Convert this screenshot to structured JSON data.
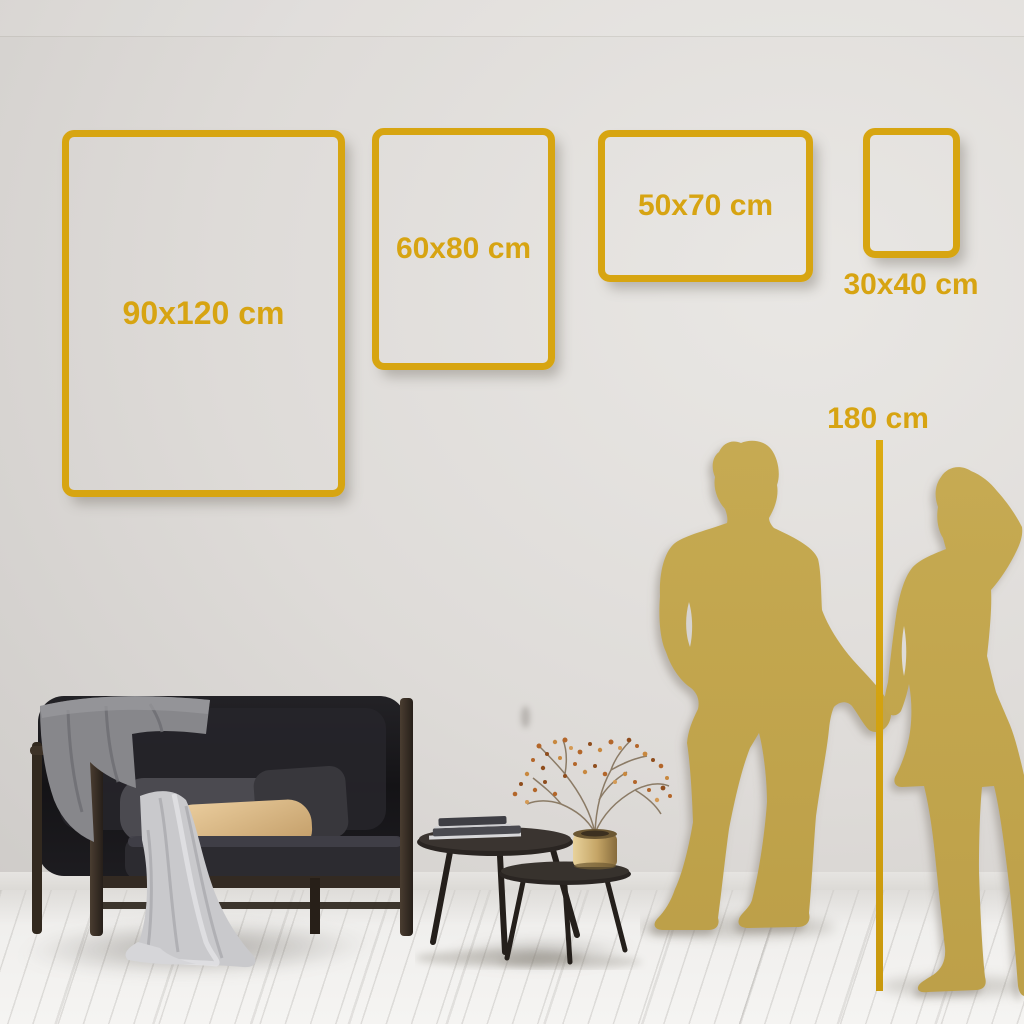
{
  "size_guide": {
    "frames": [
      {
        "label": "90x120 cm",
        "orientation": "portrait"
      },
      {
        "label": "60x80 cm",
        "orientation": "portrait"
      },
      {
        "label": "50x70 cm",
        "orientation": "landscape"
      },
      {
        "label": "30x40 cm",
        "orientation": "portrait"
      }
    ],
    "height_marker": {
      "label": "180 cm"
    }
  },
  "colors": {
    "accent_gold": "#D7A412",
    "silhouette_gold": "#C2A64E",
    "wall_light": "#E9E7E4",
    "wall_dark": "#C5C2BF",
    "floor": "#F5F4F2",
    "sofa_dark": "#1B1A1D",
    "pillow_beige": "#DDBE92"
  },
  "scene": {
    "objects": [
      "sofa",
      "throw-blanket",
      "beige-pillow",
      "draped-cloth",
      "nesting-coffee-tables",
      "books",
      "brass-vase",
      "dried-branch-plant",
      "man-silhouette",
      "woman-silhouette",
      "height-ruler",
      "wood-floor",
      "wall"
    ]
  }
}
